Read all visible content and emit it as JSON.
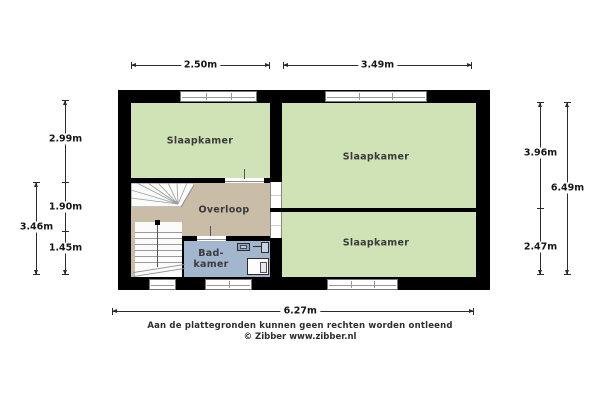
{
  "plan": {
    "rooms": {
      "bedroom_top_left": "Slaapkamer",
      "bedroom_right": "Slaapkamer",
      "bedroom_bottom_right": "Slaapkamer",
      "landing": "Overloop",
      "bathroom_line1": "Bad-",
      "bathroom_line2": "kamer"
    },
    "dimensions": {
      "top_left_width": "2.50m",
      "top_right_width": "3.49m",
      "left_top": "2.99m",
      "left_middle": "1.90m",
      "left_bottom": "1.45m",
      "left_outer": "3.46m",
      "right_top": "3.96m",
      "right_bottom": "2.47m",
      "right_outer": "6.49m",
      "bottom_total": "6.27m"
    },
    "footer": {
      "disclaimer": "Aan de plattegronden kunnen geen rechten worden ontleend",
      "copyright": "© Zibber www.zibber.nl"
    },
    "icons": {
      "sink": "sink-icon",
      "shower": "shower-icon",
      "toilet": "toilet-icon",
      "stairs": "stairs-icon"
    },
    "colors": {
      "room_green": "#d0e3b6",
      "landing_beige": "#c9bda7",
      "bathroom_blue": "#a2b6ce",
      "wall_black": "#000000"
    }
  }
}
